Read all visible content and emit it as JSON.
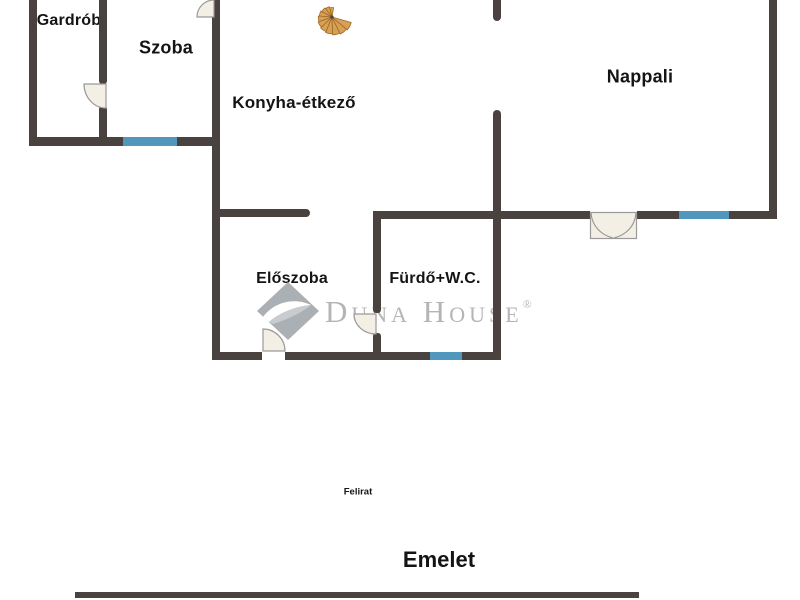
{
  "floorplan": {
    "rooms": [
      {
        "label": "Gardrób"
      },
      {
        "label": "Szoba"
      },
      {
        "label": "Konyha-étkező"
      },
      {
        "label": "Nappali"
      },
      {
        "label": "Előszoba"
      },
      {
        "label": "Fürdő+W.C."
      }
    ],
    "caption": "Felirat",
    "floor_title": "Emelet"
  },
  "watermark": {
    "brand": "Duna House",
    "registered": "®"
  },
  "icons": {
    "staircase": "spiral-staircase",
    "logo": "duna-house-diamond-swoosh"
  },
  "colors": {
    "background": "#ffffff",
    "wall": "#4a423e",
    "window": "#5096bd",
    "door_fill": "#f4efe5",
    "door_edge": "#9a9a9a",
    "stair_fill": "#d8a055",
    "stair_edge": "#9c6a26",
    "text": "#141414",
    "watermark": "#b5b5b5"
  }
}
